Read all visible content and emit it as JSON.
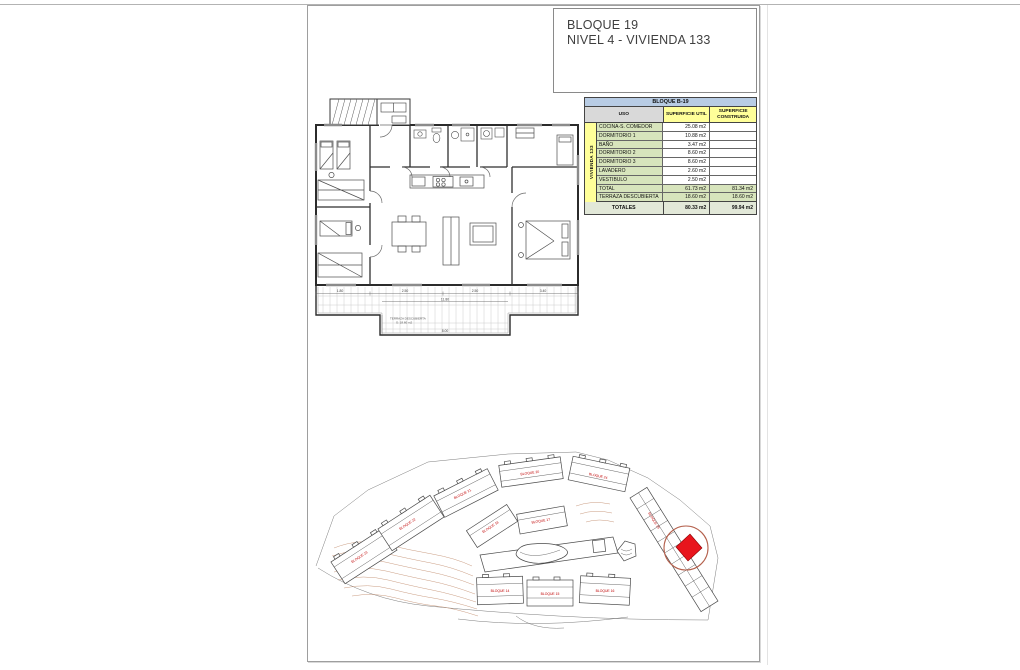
{
  "title_block": {
    "line1": "BLOQUE 19",
    "line2": "NIVEL 4 - VIVIENDA 133"
  },
  "area_table": {
    "header": "BLOQUE B-19",
    "columns": [
      "USO",
      "SUPERFICIE UTIL",
      "SUPERFICIE CONSTRUIDA"
    ],
    "row_group_label": "VIVIENDA 133",
    "rows": [
      {
        "uso": "COCINA-S. COMEDOR",
        "util": "25.08 m2",
        "construida": "",
        "highlight": false
      },
      {
        "uso": "DORMITORIO 1",
        "util": "10.88 m2",
        "construida": "",
        "highlight": false
      },
      {
        "uso": "BAÑO",
        "util": "3.47 m2",
        "construida": "",
        "highlight": false
      },
      {
        "uso": "DORMITORIO 2",
        "util": "8.60 m2",
        "construida": "",
        "highlight": false
      },
      {
        "uso": "DORMITORIO 3",
        "util": "8.60 m2",
        "construida": "",
        "highlight": false
      },
      {
        "uso": "LAVADERO",
        "util": "2.60 m2",
        "construida": "",
        "highlight": false
      },
      {
        "uso": "VESTIBULO",
        "util": "2.50 m2",
        "construida": "",
        "highlight": false
      },
      {
        "uso": "TOTAL",
        "util": "61.73 m2",
        "construida": "81.34 m2",
        "highlight": true
      },
      {
        "uso": "TERRAZA DESCUBIERTA",
        "util": "18.60 m2",
        "construida": "18.60 m2",
        "highlight": true
      }
    ],
    "totals": {
      "label": "TOTALES",
      "util": "80.33 m2",
      "construida": "99.94 m2"
    }
  },
  "floor_plan": {
    "terrace_label_line1": "TERRAZA DESCUBIERTA",
    "terrace_label_line2": "S: 18.60 m2",
    "dimensions": [
      "1.80",
      "2.50",
      "2.50",
      "3.40",
      "11.80",
      "8.00"
    ]
  },
  "site_plan": {
    "block_labels": [
      "BLOQUE 23",
      "BLOQUE 22",
      "BLOQUE 21",
      "BLOQUE 20",
      "BLOQUE 24",
      "BLOQUE 18",
      "BLOQUE 17",
      "BLOQUE 14",
      "BLOQUE 15",
      "BLOQUE 16",
      "BLOQUE 19"
    ]
  },
  "colors": {
    "accent_red": "#e8151d",
    "circle_red": "#b4604c",
    "label_red": "#c00000",
    "table_blue": "#b8cce4",
    "table_yellow": "#ffff99",
    "table_green": "#d7e4bc",
    "table_gray": "#d9d9d9",
    "contour_brown": "#c08a6a"
  }
}
